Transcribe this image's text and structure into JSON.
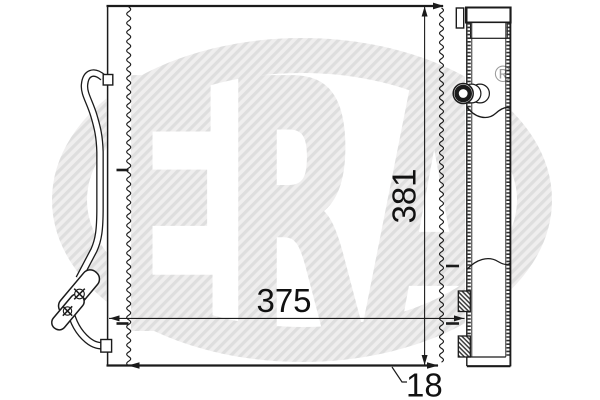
{
  "drawing": {
    "line_color": "#1b1b1b",
    "background_color": "#ffffff",
    "dimensions": {
      "width": {
        "value": "375"
      },
      "height": {
        "value": "381"
      },
      "depth": {
        "value": "18"
      }
    }
  },
  "watermark": {
    "letters": "ERA",
    "registered_symbol": "®",
    "stripe_dark": "#dedede",
    "stripe_light": "#efeeee",
    "symbol_color": "#9c9c9c"
  }
}
